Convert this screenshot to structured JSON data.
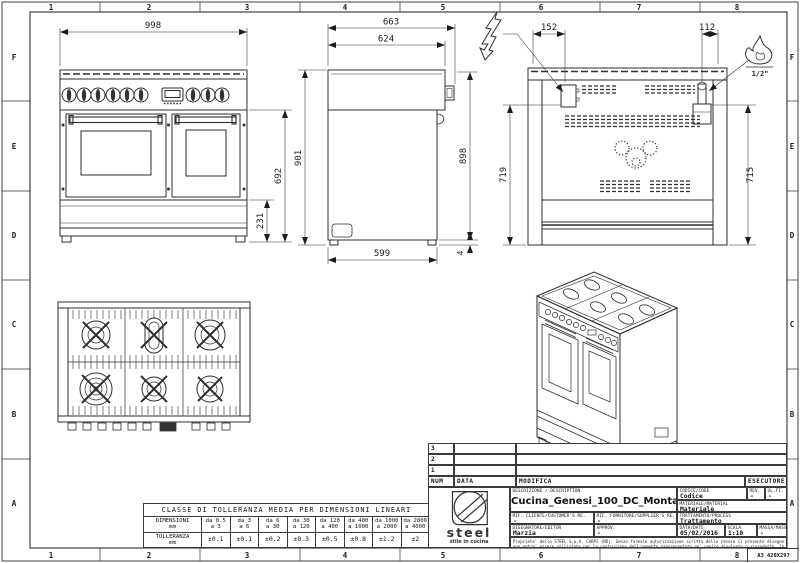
{
  "sheet": {
    "format_label": "A3 420X297"
  },
  "border": {
    "cols": [
      "1",
      "2",
      "3",
      "4",
      "5",
      "6",
      "7",
      "8"
    ],
    "rows": [
      "F",
      "E",
      "D",
      "C",
      "B",
      "A"
    ]
  },
  "views": {
    "front": {
      "dim_width": "998",
      "dim_body_height": "692",
      "dim_plinth_height": "231"
    },
    "side": {
      "dim_depth_total": "663",
      "dim_depth_body": "624",
      "dim_height_total": "901",
      "dim_height_body": "898",
      "dim_depth_base": "599",
      "dim_foot_gap": "4"
    },
    "rear": {
      "dim_electric_offset": "152",
      "dim_gas_offset": "112",
      "dim_left_height": "719",
      "dim_right_height": "715",
      "gas_connection_label": "1/2\""
    }
  },
  "tolerance_table": {
    "title": "CLASSE DI TOLLERANZA MEDIA PER DIMENSIONI LINEARI",
    "dim_label": "DIMENSIONI",
    "tol_label": "TOLLERANZA",
    "unit": "mm",
    "ranges_from": [
      "da 0.5",
      "da 3",
      "da 6",
      "da 30",
      "da 120",
      "da 400",
      "da 1000",
      "da 2000"
    ],
    "ranges_to": [
      "a 3",
      "a 6",
      "a 30",
      "a 120",
      "a 400",
      "a 1000",
      "a 2000",
      "a 4000"
    ],
    "tolerances": [
      "±0.1",
      "±0.1",
      "±0.2",
      "±0.3",
      "±0.5",
      "±0.8",
      "±1.2",
      "±2"
    ]
  },
  "title_block": {
    "revision_rows": [
      "3",
      "2",
      "1"
    ],
    "header": {
      "num": "NUM",
      "data": "DATA",
      "modifica": "MODIFICA",
      "esecutore": "ESECUTORE"
    },
    "logo": {
      "brand": "steel",
      "tagline": "stile in cucina"
    },
    "description_label": "DESCRIZIONE / DESCRIPTION",
    "description": "Cucina_Genesi_100_DC_Montaggio",
    "code_label": "CODICE/CODE",
    "code_value": "Codice",
    "rev_label": "REV.",
    "rev_value": "-",
    "sheet_label": "UL.FI.",
    "sheet_value": "-",
    "material_label": "MATERIALE/MATERIAL",
    "material_value": "Materiale",
    "customer_ref_label": "RIF. CLIENTE/CUSTOMER'S RE.",
    "customer_ref_value": "-",
    "supplier_ref_label": "RIF. FORNITORE/SUPPLIER'S RE.",
    "supplier_ref_value": "-",
    "treatment_label": "TRATTAMENTO/PROCESS",
    "treatment_value": "Trattamento",
    "designer_label": "DISEGNATORE/EDITOR",
    "designer_value": "Marzia",
    "approval_label": "APPROV.",
    "approval_value": "-",
    "date_label": "DATA/DATE",
    "date_value": "05/02/2016",
    "scale_label": "SCALA",
    "scale_value": "1:10",
    "mass_label": "MASSA/MASS Kg",
    "mass_value": "-",
    "legal_text": "Proprieta' dello STEEL S.p.A. CARPI (MO). Senza formale autorizzazione scritta della stessa il presente disegno non potra' essere utilizzato per la costruzione dell'oggetto rappresentato ne' venire divulgato o riprodotto, la proprietaria tutela i propri diritti a rigore di legge."
  }
}
